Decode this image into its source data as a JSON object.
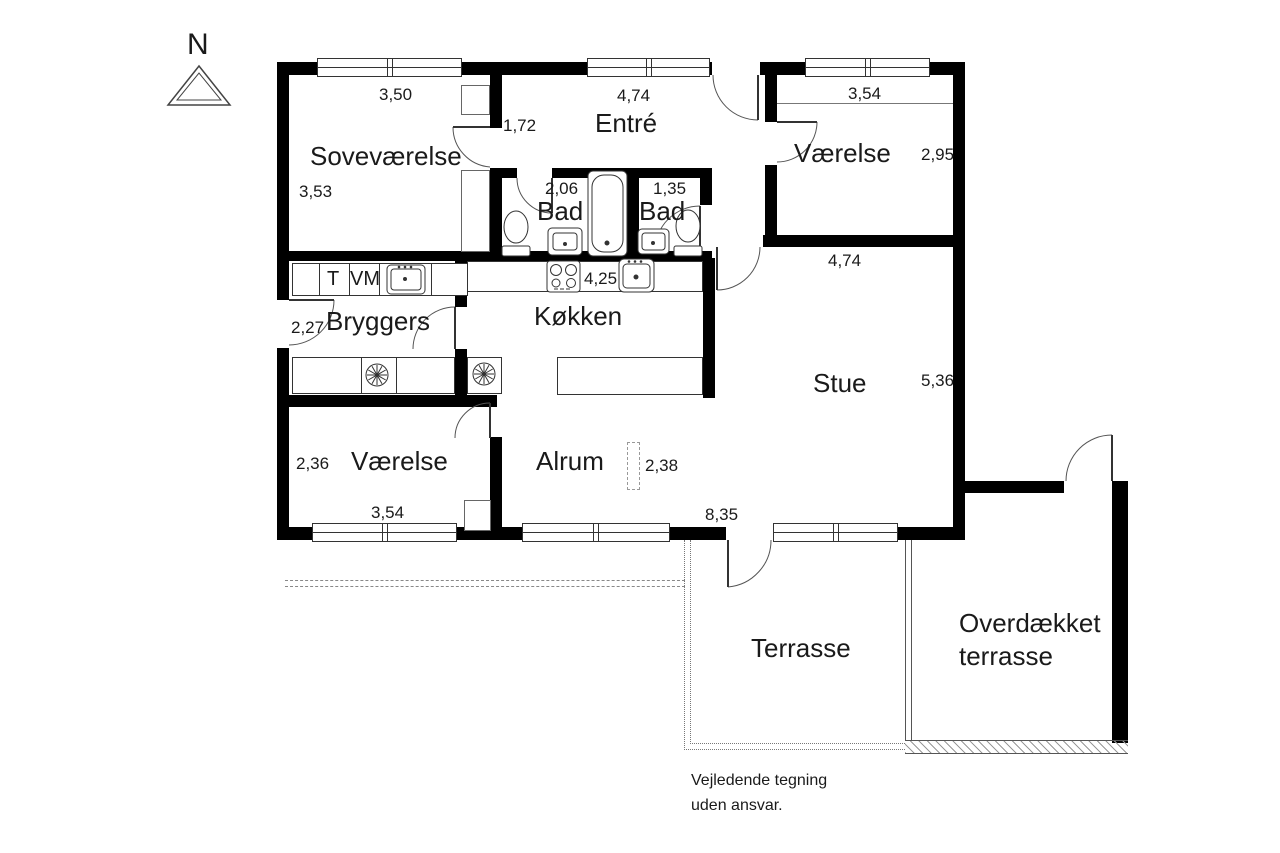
{
  "north": {
    "label": "N"
  },
  "rooms": {
    "sovevaerelse": {
      "name": "Soveværelse",
      "dim_width": "3,50",
      "dim_height": "3,53"
    },
    "entre": {
      "name": "Entré",
      "dim_width": "4,74",
      "dim_hall": "1,72"
    },
    "vaerelse_ne": {
      "name": "Værelse",
      "dim_width": "3,54",
      "dim_height": "2,95"
    },
    "bad_left": {
      "name": "Bad",
      "dim_width": "2,06"
    },
    "bad_right": {
      "name": "Bad",
      "dim_width": "1,35"
    },
    "bryggers": {
      "name": "Bryggers",
      "dim_width": "2,27"
    },
    "koekken": {
      "name": "Køkken",
      "dim_width": "4,25"
    },
    "stue": {
      "name": "Stue",
      "dim_width": "4,74",
      "dim_height": "5,36"
    },
    "vaerelse_sw": {
      "name": "Værelse",
      "dim_height": "2,36",
      "dim_width": "3,54"
    },
    "alrum": {
      "name": "Alrum",
      "dim_width": "2,38"
    },
    "terrasse": {
      "name": "Terrasse"
    },
    "overdaekket_terrasse": {
      "name_line1": "Overdækket",
      "name_line2": "terrasse"
    }
  },
  "dimensions": {
    "south_total": "8,35"
  },
  "appliances": {
    "dryer": "T",
    "washing_machine": "VM"
  },
  "disclaimer": {
    "line1": "Vejledende tegning",
    "line2": "uden ansvar."
  }
}
